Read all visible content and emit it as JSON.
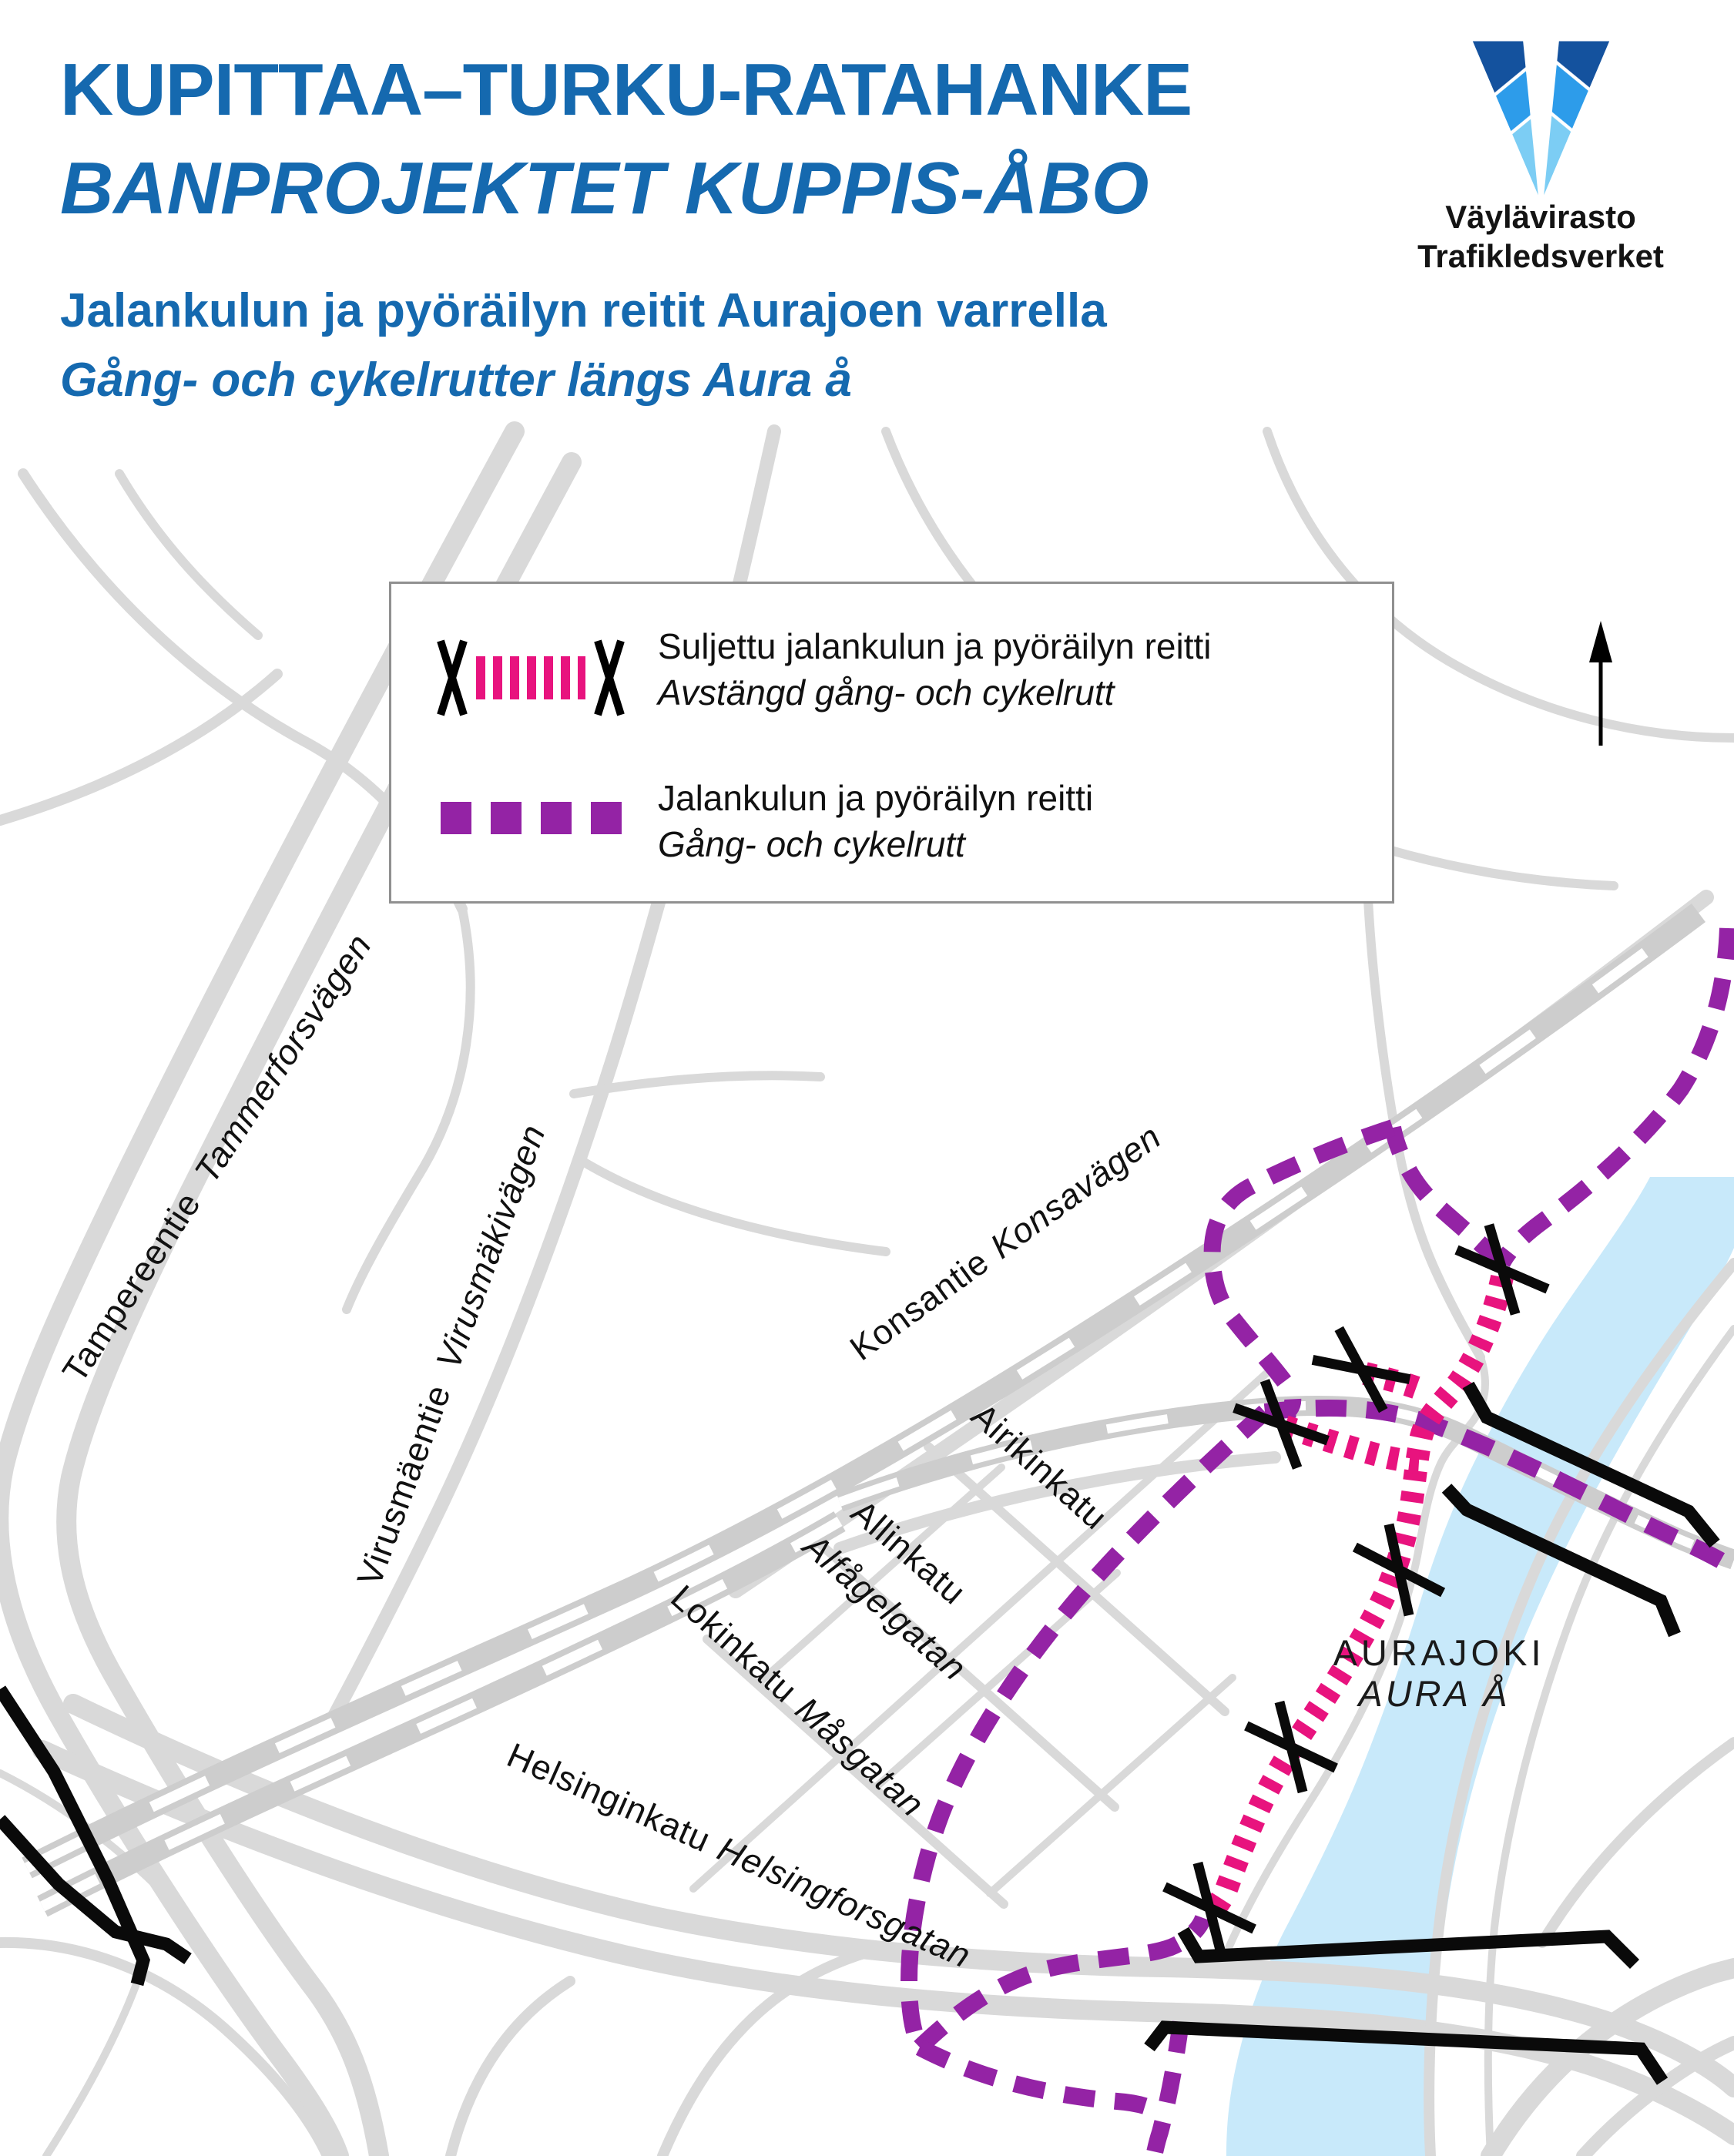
{
  "header": {
    "title_fi": "KUPITTAA–TURKU-RATAHANKE",
    "title_sv": "BANPROJEKTET KUPPIS-ÅBO",
    "subtitle_fi": "Jalankulun ja pyöräilyn reitit Aurajoen varrella",
    "subtitle_sv": "Gång- och cykelrutter längs Aura å",
    "accent_color": "#1569AF"
  },
  "logo": {
    "name_fi": "Väylävirasto",
    "name_sv": "Trafikledsverket",
    "mark_colors": {
      "dark": "#14529E",
      "mid": "#2D9CEA",
      "light": "#7CCDF4"
    }
  },
  "legend": {
    "items": [
      {
        "symbol": "closed-route",
        "label_fi": "Suljettu jalankulun ja pyöräilyn reitti",
        "label_sv": "Avstängd gång- och cykelrutt",
        "color": "#E8137E"
      },
      {
        "symbol": "open-route",
        "label_fi": "Jalankulun ja pyöräilyn reitti",
        "label_sv": "Gång- och cykelrutt",
        "color": "#9423A5"
      }
    ]
  },
  "map": {
    "river": {
      "label_fi": "AURAJOKI",
      "label_sv": "AURA Å"
    },
    "streets": {
      "tampereentie": {
        "fi": "Tampereentie",
        "sv": "Tammerforsvägen"
      },
      "virusmaentie": {
        "fi": "Virusmäentie",
        "sv": "Virusmäkivägen"
      },
      "konsantie": {
        "fi": "Konsantie",
        "sv": "Konsavägen"
      },
      "airikinkatu": {
        "fi": "Airikinkatu",
        "sv": ""
      },
      "allinkatu": {
        "fi": "Allinkatu",
        "sv": "Alfågelgatan"
      },
      "lokinkatu": {
        "fi": "Lokinkatu",
        "sv": "Måsgatan"
      },
      "helsinginkatu": {
        "fi": "Helsinginkatu",
        "sv": "Helsingforsgatan"
      }
    },
    "colors": {
      "route_open": "#9423A5",
      "route_closed": "#E8137E",
      "river": "#C8E9FA",
      "road": "#D9D9D9",
      "railway": "#CDCDCD",
      "closure": "#0A0A0A"
    }
  }
}
